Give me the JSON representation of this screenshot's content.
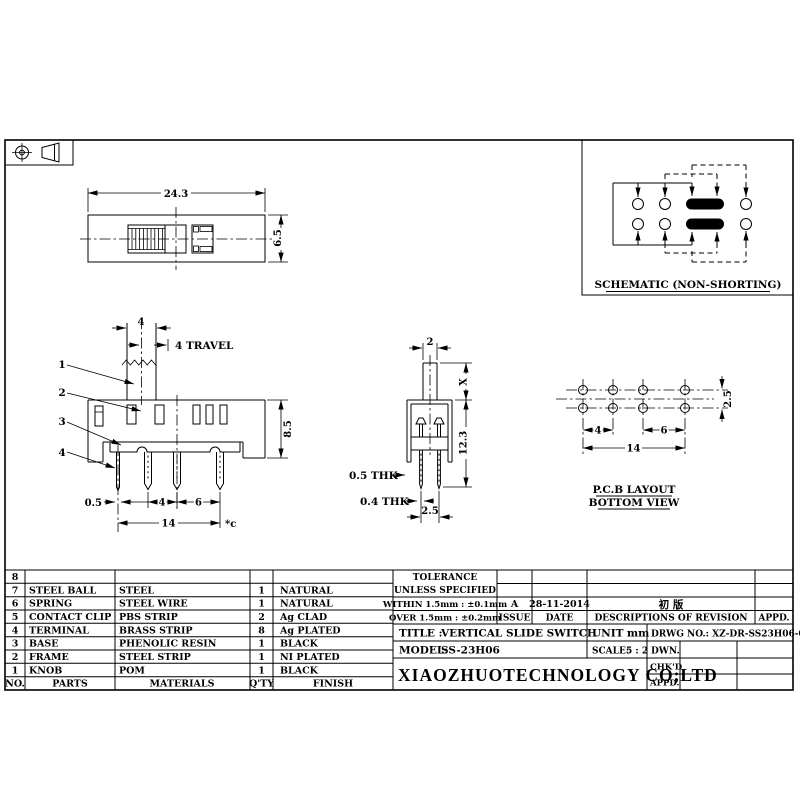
{
  "schematic": {
    "caption": "SCHEMATIC (NON-SHORTING)"
  },
  "top_view": {
    "width": "24.3",
    "height": "6.5"
  },
  "front_view": {
    "knob_width": "4",
    "travel_label": "4 TRAVEL",
    "body_height": "8.5",
    "leader_1": "1",
    "leader_2": "2",
    "leader_3": "3",
    "leader_4": "4",
    "terminal_width": "0.5",
    "pitch_a": "4",
    "pitch_b": "6",
    "span": "14",
    "note": "*c"
  },
  "side_view": {
    "stem_width": "2",
    "dim_x": "X",
    "total_height": "12.3",
    "frame_thickness": "0.5 THK",
    "terminal_thickness": "0.4 THK",
    "row_pitch": "2.5"
  },
  "pcb_layout": {
    "pitch_a": "4",
    "pitch_b": "6",
    "span": "14",
    "row_pitch": "2.5",
    "title": "P.C.B LAYOUT",
    "subtitle": "BOTTOM VIEW"
  },
  "parts_table": {
    "headers": {
      "no": "NO.",
      "parts": "PARTS",
      "materials": "MATERIALS",
      "qty": "Q'TY",
      "finish": "FINISH"
    },
    "rows": [
      {
        "no": "8",
        "part": "",
        "material": "",
        "qty": "",
        "finish": ""
      },
      {
        "no": "7",
        "part": "STEEL BALL",
        "material": "STEEL",
        "qty": "1",
        "finish": "NATURAL"
      },
      {
        "no": "6",
        "part": "SPRING",
        "material": "STEEL WIRE",
        "qty": "1",
        "finish": "NATURAL"
      },
      {
        "no": "5",
        "part": "CONTACT CLIP",
        "material": "PBS STRIP",
        "qty": "2",
        "finish": "Ag CLAD"
      },
      {
        "no": "4",
        "part": "TERMINAL",
        "material": "BRASS STRIP",
        "qty": "8",
        "finish": "Ag PLATED"
      },
      {
        "no": "3",
        "part": "BASE",
        "material": "PHENOLIC RESIN",
        "qty": "1",
        "finish": "BLACK"
      },
      {
        "no": "2",
        "part": "FRAME",
        "material": "STEEL STRIP",
        "qty": "1",
        "finish": "NI PLATED"
      },
      {
        "no": "1",
        "part": "KNOB",
        "material": "POM",
        "qty": "1",
        "finish": "BLACK"
      }
    ]
  },
  "title_block": {
    "tolerance_line1": "TOLERANCE",
    "tolerance_line2": "UNLESS  SPECIFIED",
    "within": "WITHIN 1.5mm : ±0.1mm",
    "over": "OVER 1.5mm : ±0.2mm",
    "issue_value": "A",
    "date_value": "28-11-2014",
    "revision_value": "初 版",
    "issue_label": "ISSUE",
    "date_label": "DATE",
    "descriptions_label": "DESCRIPTIONS OF REVISION",
    "appd_label": "APPD.",
    "title_label": "TITLE :",
    "title_value": "VERTICAL SLIDE SWITCH",
    "unit_label": "UNIT :",
    "unit_value": "mm",
    "drwg_no": "DRWG NO.: XZ-DR-SS23H06-00",
    "model_label": "MODEL:",
    "model_value": "SS-23H06",
    "scale_label": "SCALE:",
    "scale_value": "5 : 2",
    "dwn_label": "DWN.",
    "chkd_label": "CHK'D",
    "appd2_label": "APPD.",
    "company": "XIAOZHUOTECHNOLOGY  CO;LTD"
  }
}
